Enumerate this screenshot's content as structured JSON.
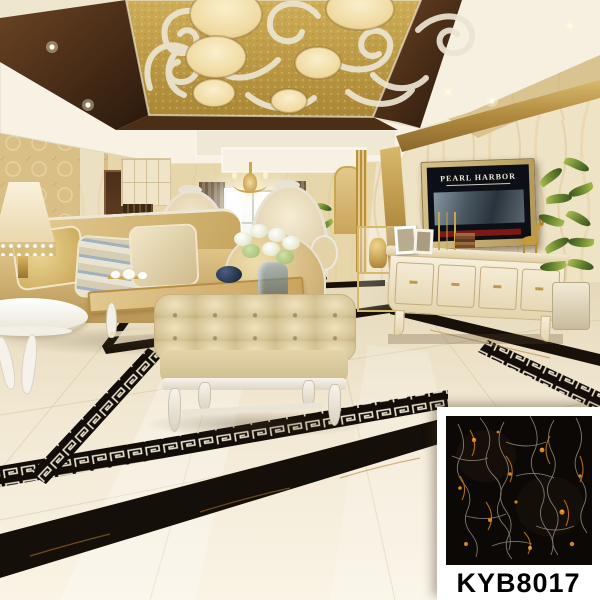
{
  "meta": {
    "type": "product-showcase-photo",
    "subject": "Luxury European living room with polished cream marble tile floor, black marble inlay borders and Greek-key mosaic bands"
  },
  "tv": {
    "movie_title": "PEARL HARBOR"
  },
  "product": {
    "code": "KYB8017"
  },
  "palette": {
    "floor_cream": "#f4ebd7",
    "ceiling_gold": "#c5a04a",
    "ceiling_brown": "#3c2412",
    "cornice_white": "#f7f2e4",
    "wall_gold": "#d9bf85",
    "marble_wall": "#efe3c6",
    "sofa_gold": "#d9bd7e",
    "leather_cream": "#d9c89e",
    "inlay_black": "#120d08",
    "key_cream": "#efe7d2",
    "vein_gold": "#c1761d",
    "swatch_bg": "#ffffff",
    "label_color": "#000000"
  }
}
